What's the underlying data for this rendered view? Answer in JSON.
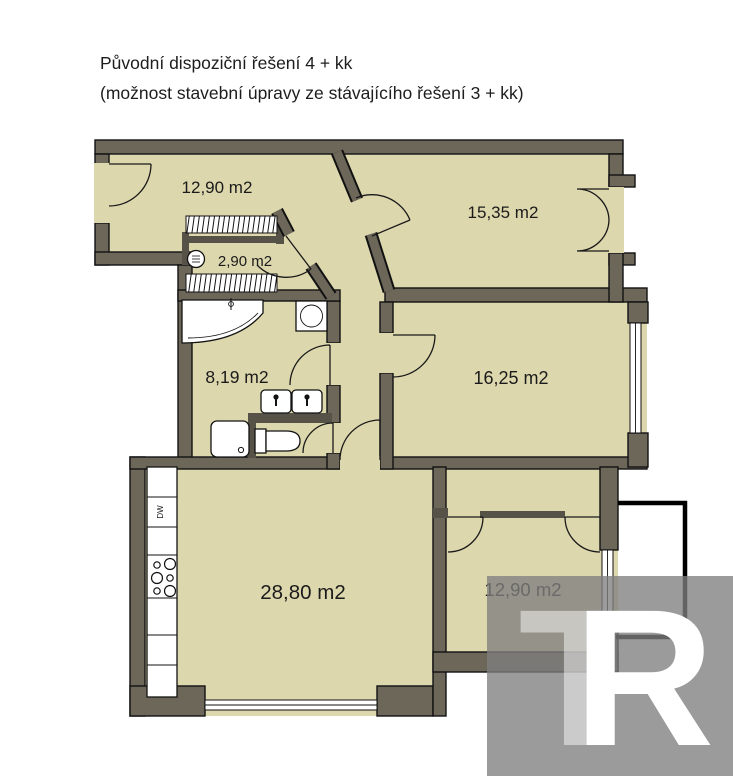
{
  "title": {
    "line1": "Původní dispoziční řešení 4 + kk",
    "line2": "(možnost stavební úpravy ze stávajícího řešení 3 + kk)"
  },
  "rooms": {
    "hallway": "12,90 m2",
    "bedroom_top_right": "15,35 m2",
    "closet": "2,90 m2",
    "bathroom": "8,19 m2",
    "bedroom_middle_right": "16,25 m2",
    "living_room_kitchen": "28,80 m2",
    "bedroom_bottom_right": "12,90 m2"
  },
  "kitchen": {
    "dishwasher_label": "DW"
  },
  "watermark": {
    "letter1": "T",
    "letter2": "R"
  },
  "colors": {
    "floor": "#ddd7ad",
    "wall": "#6c6759",
    "outline": "#121212",
    "balcony_line": "#000000",
    "watermark_gray": "#7f7f7f",
    "white": "#ffffff"
  }
}
